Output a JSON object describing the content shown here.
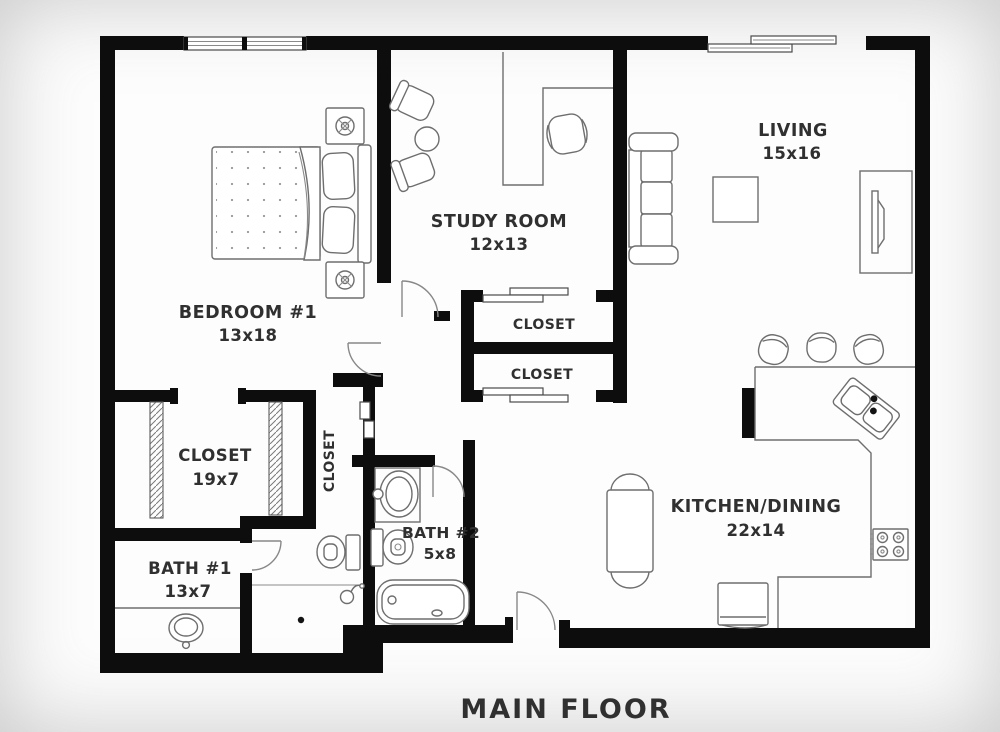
{
  "page": {
    "title_label": "MAIN FLOOR"
  },
  "colors": {
    "wall": "#0d0d0d",
    "furniture_line": "#6e6e6e",
    "label_text": "#303030",
    "background": "#fdfdfd"
  },
  "rooms": {
    "bedroom1": {
      "name": "BEDROOM #1",
      "dims": "13x18"
    },
    "study": {
      "name": "STUDY ROOM",
      "dims": "12x13"
    },
    "living": {
      "name": "LIVING",
      "dims": "15x16"
    },
    "kitchen_dining": {
      "name": "KITCHEN/DINING",
      "dims": "22x14"
    },
    "bath1": {
      "name": "BATH #1",
      "dims": "13x7"
    },
    "bath2": {
      "name": "BATH #2",
      "dims": "5x8"
    },
    "closet_long": {
      "name": "CLOSET",
      "dims": "19x7"
    },
    "closet_hall": {
      "name": "CLOSET"
    },
    "closet_upper": {
      "name": "CLOSET"
    },
    "closet_lower": {
      "name": "CLOSET"
    }
  },
  "fixtures": [
    "double-bed",
    "nightstand-lamp-top",
    "nightstand-lamp-bottom",
    "bedroom-window",
    "patio-sliding-door",
    "lounge-chair-1",
    "lounge-chair-2",
    "side-table",
    "l-desk",
    "desk-chair",
    "sofa",
    "coffee-table",
    "tv-console",
    "closet-sliding-doors",
    "closet-hatched-panels",
    "linen-door-panels",
    "kitchen-counter",
    "double-kitchen-sink",
    "stove",
    "refrigerator",
    "bar-stool-1",
    "bar-stool-2",
    "bar-stool-3",
    "dining-table",
    "dining-chairs",
    "vanity-sink-bath1",
    "toilet-bath1",
    "shower-head",
    "shower-drain",
    "vanity-sink-bath2",
    "toilet-bath2",
    "bathtub",
    "entry-door",
    "bedroom-door",
    "study-door",
    "bath1-door",
    "bath2-door"
  ]
}
